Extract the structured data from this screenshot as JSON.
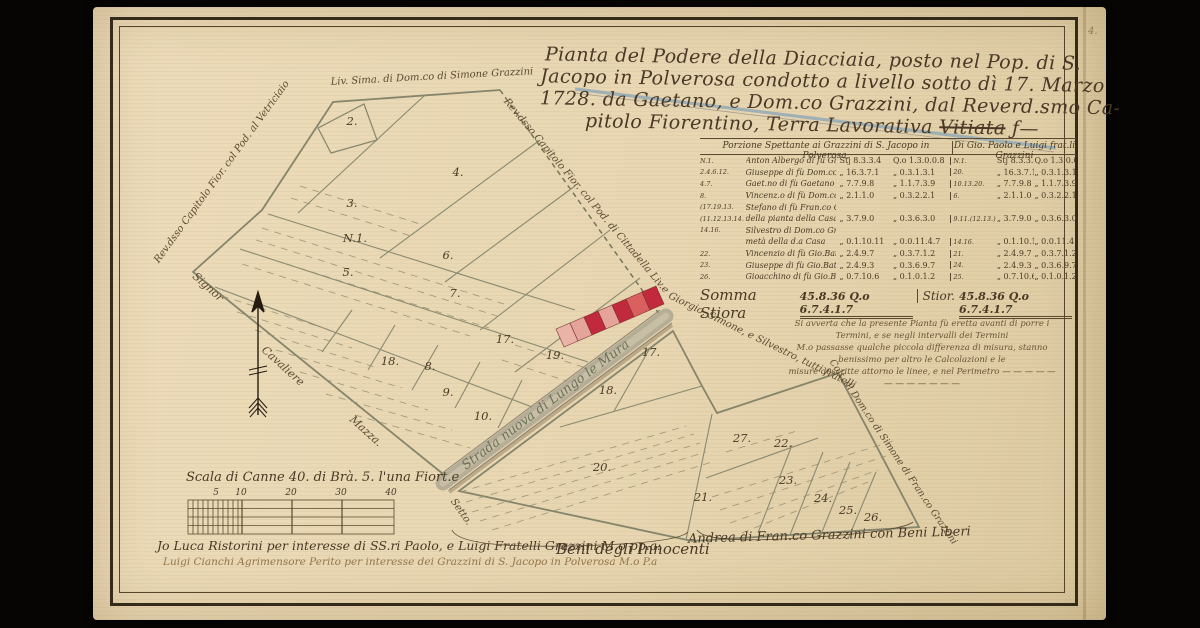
{
  "page_mark": "4.",
  "title": {
    "lines": [
      "Pianta del Podere della Diacciaia, posto nel Pop. di S.",
      "Jacopo in Polverosa condotto a livello sotto dì 17. Marzo",
      "1728. da Gaetano, e Dom.co Grazzini, dal Reverd.smo Ca-"
    ],
    "line4": "pitolo Fiorentino, Terra Lavorativa ",
    "struck": "Vitiata",
    "tail": " ƒ—"
  },
  "table": {
    "header_left": "Porzione Spettante ai Grazzini di S. Jacopo in Polverosa.",
    "header_right": "Di Gio. Paolo e Luigi frat.li Grazzini",
    "rows": [
      {
        "ref": "N.1.",
        "name": "Anton Albergo di fù Giusef. Grazzini",
        "v1": "Stj 8.3.3.4",
        "v2": "Q.o 1.3.0.0.8",
        "ref2": "N.1.",
        "rv1": "Stj 8.3.3.4",
        "rv2": "Q.o 1.3.0.0.8"
      },
      {
        "ref": "2.4.6.12.",
        "name": "Giuseppe di fù Dom.co Grazzini",
        "v1": "„ 16.3.7.1",
        "v2": "„ 0.3.1.3.1",
        "ref2": "20.",
        "rv1": "„ 16.3.7.1",
        "rv2": "„ 0.3.1.3.1"
      },
      {
        "ref": "4.7.",
        "name": "Gaet.no di fù Gaetano Grazzini",
        "v1": "„ 7.7.9.8",
        "v2": "„ 1.1.7.3.9",
        "ref2": "10.13.20.",
        "rv1": "„ 7.7.9.8",
        "rv2": "„ 1.1.7.3.9"
      },
      {
        "ref": "8.",
        "name": "Vincenz.o di fù Dom.co Grazzini",
        "v1": "„ 2.1.1.0",
        "v2": "„ 0.3.2.2.1",
        "ref2": "6.",
        "rv1": "„ 2.1.1.0",
        "rv2": "„ 0.3.2.2.1"
      },
      {
        "ref": "(17.19.13.",
        "name": "Stefano di fù Fran.co Cheli, e per anco",
        "v1": "",
        "v2": "",
        "ref2": "",
        "rv1": "",
        "rv2": ""
      },
      {
        "ref": "(11.12.13.14.",
        "name": "della pianta della Casa per metà",
        "v1": "„ 3.7.9.0",
        "v2": "„ 0.3.6.3.0",
        "ref2": "9.11.(12.13.)",
        "rv1": "„ 3.7.9.0",
        "rv2": "„ 0.3.6.3.0"
      },
      {
        "ref": "14.16.",
        "name": "Silvestro di Dom.co Grazzini per la",
        "v1": "",
        "v2": "",
        "ref2": "",
        "rv1": "",
        "rv2": ""
      },
      {
        "ref": "",
        "name": "metà della d.a Casa",
        "v1": "„ 0.1.10.11",
        "v2": "„ 0.0.11.4.7",
        "ref2": "14.16.",
        "rv1": "„ 0.1.10.11",
        "rv2": "„ 0.0.11.4.7"
      },
      {
        "ref": "22.",
        "name": "Vincenzio di fù Gio.Batt.a Grazzini",
        "v1": "„ 2.4.9.7",
        "v2": "„ 0.3.7.1.2",
        "ref2": "21.",
        "rv1": "„ 2.4.9.7",
        "rv2": "„ 0.3.7.1.2"
      },
      {
        "ref": "23.",
        "name": "Giuseppe di fù Gio.Batt.a Grazzini",
        "v1": "„ 2.4.9.3",
        "v2": "„ 0.3.6.9.7",
        "ref2": "24.",
        "rv1": "„ 2.4.9.3",
        "rv2": "„ 0.3.6.9.7"
      },
      {
        "ref": "26.",
        "name": "Gioacchino di fù Gio.Batt.a Grazzini",
        "v1": "„ 0.7.10.6",
        "v2": "„ 0.1.0.1.2",
        "ref2": "25.",
        "rv1": "„ 0.7.10.6",
        "rv2": "„ 0.1.0.1.2"
      }
    ],
    "sum": {
      "label_left": "Somma Stiora",
      "vals_left": "45.8.36 Q.o 6.7.4.1.7",
      "label_right": "Stior.",
      "vals_right": "45.8.36 Q.o 6.7.4.1.7"
    }
  },
  "note": {
    "lines": [
      "Si avverta che la presente Pianta fù eretta avanti di porre i Termini, e se negli intervalli dei Termini",
      "M.o passasse qualche piccola differenza di misura, stanno benissimo per altro le Calcolazioni e le",
      "misure descritte attorno le linee, e nel Perimetro — — — — — — — — — — — —"
    ]
  },
  "map": {
    "road_label": "Strada nuova di Lungo le Mura",
    "edge_labels": [
      {
        "text": "Rev.dsso Capitolo Fior. col Pod. al Vetriciaio",
        "x": 222,
        "y": 172,
        "rot": -54,
        "fs": 10
      },
      {
        "text": "Liv. Sima. di Dom.co di Simone Grazzini",
        "x": 432,
        "y": 77,
        "rot": -3,
        "fs": 10
      },
      {
        "text": "Rev.dsso Capitolo Fior. col Pod. di Cittadella Liv.e",
        "x": 586,
        "y": 196,
        "rot": 50,
        "fs": 10
      },
      {
        "text": "Giorgio, Simone, e Silvestro, tutti fratelli",
        "x": 762,
        "y": 341,
        "rot": 26,
        "fs": 10
      },
      {
        "text": "Colt. di Dom.co di Simone di Fran.co Grazzini",
        "x": 893,
        "y": 452,
        "rot": 56,
        "fs": 9.5
      },
      {
        "text": "Signor",
        "x": 208,
        "y": 287,
        "rot": 42,
        "fs": 11
      },
      {
        "text": "Cavaliere",
        "x": 283,
        "y": 366,
        "rot": 42,
        "fs": 11
      },
      {
        "text": "Mazza.",
        "x": 366,
        "y": 431,
        "rot": 42,
        "fs": 11
      },
      {
        "text": "Setto.",
        "x": 461,
        "y": 512,
        "rot": 55,
        "fs": 10
      }
    ],
    "parcels": [
      {
        "n": "2.",
        "x": 352,
        "y": 121
      },
      {
        "n": "N.1.",
        "x": 355,
        "y": 238
      },
      {
        "n": "3.",
        "x": 352,
        "y": 203
      },
      {
        "n": "4.",
        "x": 458,
        "y": 172
      },
      {
        "n": "5.",
        "x": 348,
        "y": 272
      },
      {
        "n": "6.",
        "x": 448,
        "y": 255
      },
      {
        "n": "7.",
        "x": 455,
        "y": 293
      },
      {
        "n": "17.",
        "x": 505,
        "y": 339
      },
      {
        "n": "18.",
        "x": 390,
        "y": 361
      },
      {
        "n": "8.",
        "x": 430,
        "y": 366
      },
      {
        "n": "9.",
        "x": 448,
        "y": 392
      },
      {
        "n": "10.",
        "x": 483,
        "y": 416
      },
      {
        "n": "19.",
        "x": 555,
        "y": 355
      },
      {
        "n": "17.",
        "x": 651,
        "y": 352
      },
      {
        "n": "18.",
        "x": 608,
        "y": 390
      },
      {
        "n": "20.",
        "x": 602,
        "y": 467
      },
      {
        "n": "27.",
        "x": 742,
        "y": 438
      },
      {
        "n": "22.",
        "x": 783,
        "y": 443
      },
      {
        "n": "21.",
        "x": 703,
        "y": 497
      },
      {
        "n": "23.",
        "x": 788,
        "y": 480
      },
      {
        "n": "24.",
        "x": 823,
        "y": 498
      },
      {
        "n": "25.",
        "x": 848,
        "y": 510
      },
      {
        "n": "26.",
        "x": 873,
        "y": 517
      }
    ]
  },
  "scale": {
    "label": "Scala di Canne 40. di Brà. 5. l'una Fiort.e",
    "ticks": [
      {
        "t": "5",
        "x": 216
      },
      {
        "t": "10",
        "x": 241
      },
      {
        "t": "20",
        "x": 291
      },
      {
        "t": "30",
        "x": 341
      },
      {
        "t": "40",
        "x": 391
      }
    ]
  },
  "signatures": {
    "line1": "Jo Luca Ristorini per interesse di SS.ri Paolo, e Luigi Fratelli Grazzini M.o pp.a:",
    "beni": "Beni degli Innocenti",
    "andrea": "Andrea di Fran.co Grazzini con Beni Liberi",
    "line2": "Luigi Cianchi Agrimensore Perito per interesse dei Grazzini di S. Jacopo in Polverosa M.o P.a"
  },
  "colors": {
    "parchment": "#e9dab8",
    "ink": "#4a3a24",
    "map_line": "#8a8a70",
    "house_red": "#c1293c",
    "house_pink": "#e5a49a",
    "water_blue": "#93aab6",
    "road": "#b6ad97"
  }
}
